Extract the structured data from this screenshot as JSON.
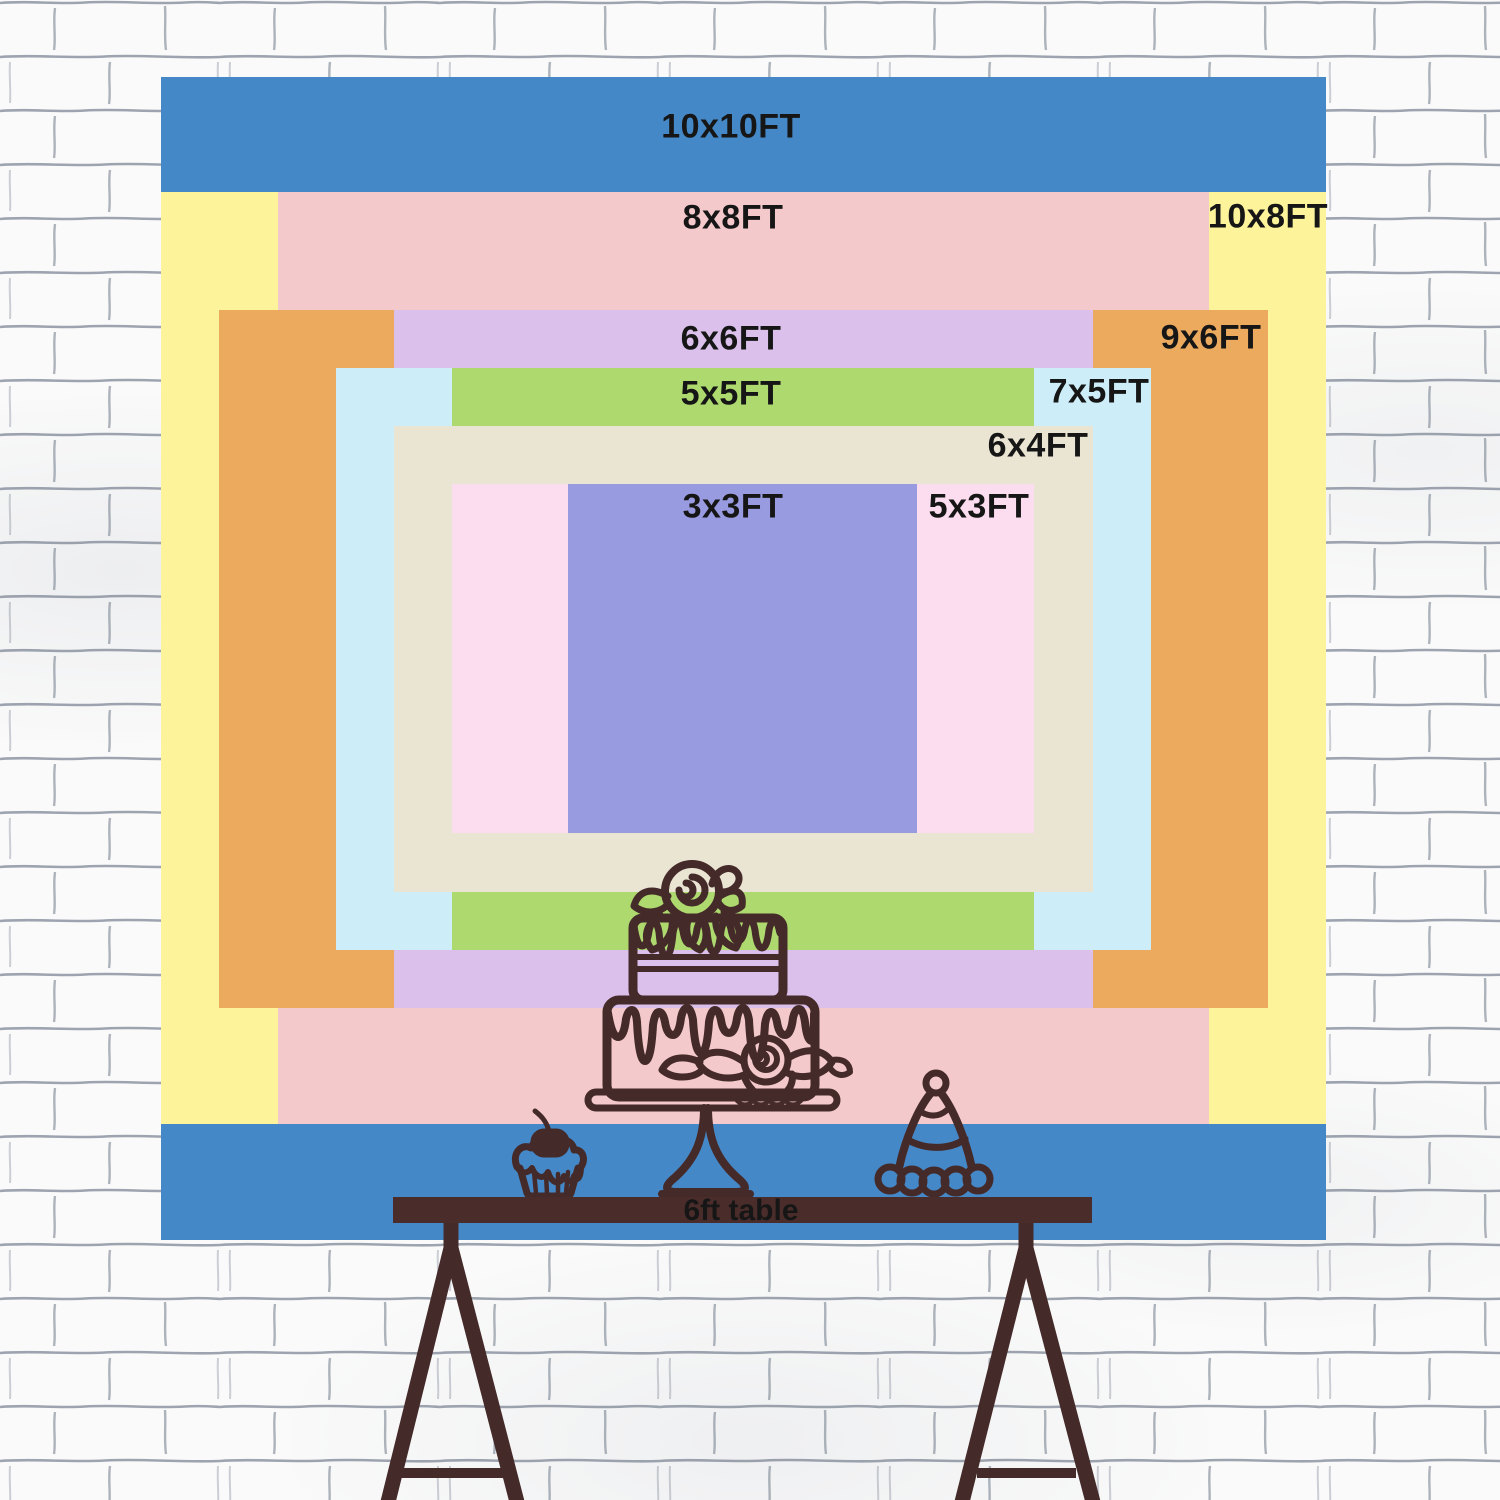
{
  "text_color": "#161616",
  "sizes": [
    {
      "label": "10x10FT",
      "width_ft": 10,
      "height_ft": 10,
      "color": "#4588c7"
    },
    {
      "label": "10x8FT",
      "width_ft": 10,
      "height_ft": 8,
      "color": "#fcf39b"
    },
    {
      "label": "8x8FT",
      "width_ft": 8,
      "height_ft": 8,
      "color": "#f4c9cb"
    },
    {
      "label": "9x6FT",
      "width_ft": 9,
      "height_ft": 6,
      "color": "#ecaa5f"
    },
    {
      "label": "6x6FT",
      "width_ft": 6,
      "height_ft": 6,
      "color": "#dac0ea"
    },
    {
      "label": "7x5FT",
      "width_ft": 7,
      "height_ft": 5,
      "color": "#cdeef8"
    },
    {
      "label": "5x5FT",
      "width_ft": 5,
      "height_ft": 5,
      "color": "#add96e"
    },
    {
      "label": "6x4FT",
      "width_ft": 6,
      "height_ft": 4,
      "color": "#eae5d3"
    },
    {
      "label": "5x3FT",
      "width_ft": 5,
      "height_ft": 3,
      "color": "#fcdcef"
    },
    {
      "label": "3x3FT",
      "width_ft": 3,
      "height_ft": 3,
      "color": "#999be1"
    }
  ],
  "table": {
    "label": "6ft table",
    "color": "#4a2d2b"
  },
  "artwork": {
    "stroke_color": "#452a2a",
    "illustrations": [
      "tiered-cake-on-stand",
      "cupcake-with-cherry",
      "party-hat"
    ]
  },
  "wall": {
    "base_color": "#fafafa",
    "mortar_color": "#7d8795"
  }
}
